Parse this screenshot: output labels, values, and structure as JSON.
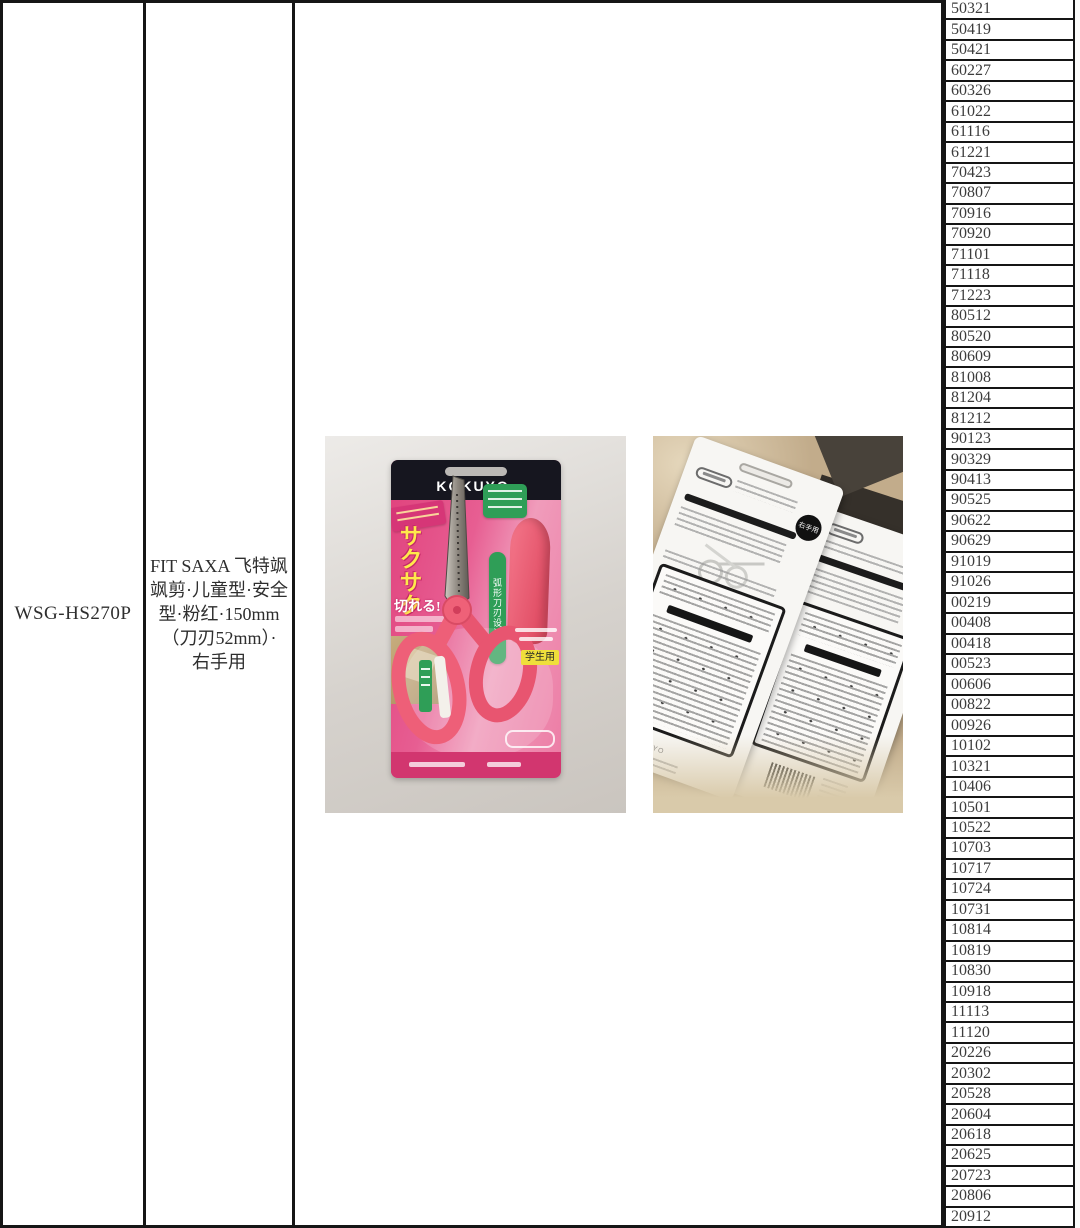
{
  "document": {
    "product_code": "WSG-HS270P",
    "product_description": "FIT SAXA 飞特飒\n飒剪·儿童型·安全\n型·粉红·150mm\n（刀刃52mm）·\n右手用",
    "codes": [
      "50321",
      "50419",
      "50421",
      "60227",
      "60326",
      "61022",
      "61116",
      "61221",
      "70423",
      "70807",
      "70916",
      "70920",
      "71101",
      "71118",
      "71223",
      "80512",
      "80520",
      "80609",
      "81008",
      "81204",
      "81212",
      "90123",
      "90329",
      "90413",
      "90525",
      "90622",
      "90629",
      "91019",
      "91026",
      "00219",
      "00408",
      "00418",
      "00523",
      "00606",
      "00822",
      "00926",
      "10102",
      "10321",
      "10406",
      "10501",
      "10522",
      "10703",
      "10717",
      "10724",
      "10731",
      "10814",
      "10819",
      "10830",
      "10918",
      "11113",
      "11120",
      "20226",
      "20302",
      "20528",
      "20604",
      "20618",
      "20625",
      "20723",
      "20806",
      "20912"
    ]
  },
  "front_photo": {
    "brand": "KOKUYO.",
    "burst_text": "サクサク",
    "cut_text": "切れる!",
    "blade_label": "弧形刀刃设计",
    "student_badge": "学生用"
  },
  "back_photo": {
    "hand_badge": "右手用",
    "brand": "KOKUYO"
  },
  "colors": {
    "card_pink": "#e75e92",
    "accent_green": "#2f9e57",
    "badge_yellow": "#efdf3b",
    "header_navy": "#16161f"
  }
}
